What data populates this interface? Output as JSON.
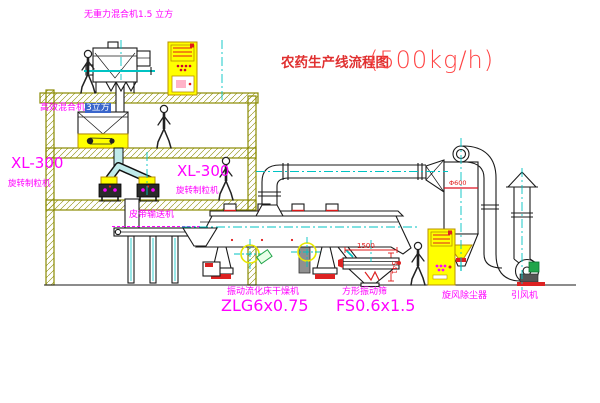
{
  "title": {
    "text_cn": "农药生产线流程图",
    "capacity": "(500kg/h)"
  },
  "labels": {
    "gravity_mixer": "无重力混合机1.5 立方",
    "mixer_main": "高效混合机",
    "mixer_highlight": "3立方",
    "granulator_model_left": "XL-300",
    "granulator_name_left": "旋转制粒机",
    "granulator_model_mid": "XL-300",
    "granulator_name_mid": "旋转制粒机",
    "belt_conveyor": "皮带输送机",
    "dryer_name": "振动流化床干燥机",
    "dryer_model": "ZLG6x0.75",
    "sieve_name": "方形振动筛",
    "sieve_model": "FS0.6x1.5",
    "cyclone": "旋风除尘器",
    "fan": "引风机"
  },
  "dimensions": {
    "sieve_length": "1500",
    "sieve_height": "541",
    "cyclone_dia": "Φ600"
  },
  "colors": {
    "magenta": "#ff00ff",
    "red": "#e01818",
    "olive": "#8a8a00",
    "cyan": "#00c3c3",
    "yellow": "#ffff00",
    "green": "#21a54a",
    "line": "#1a1a1a",
    "title_red": "#e03030",
    "highlight_blue": "#3a66cc"
  }
}
